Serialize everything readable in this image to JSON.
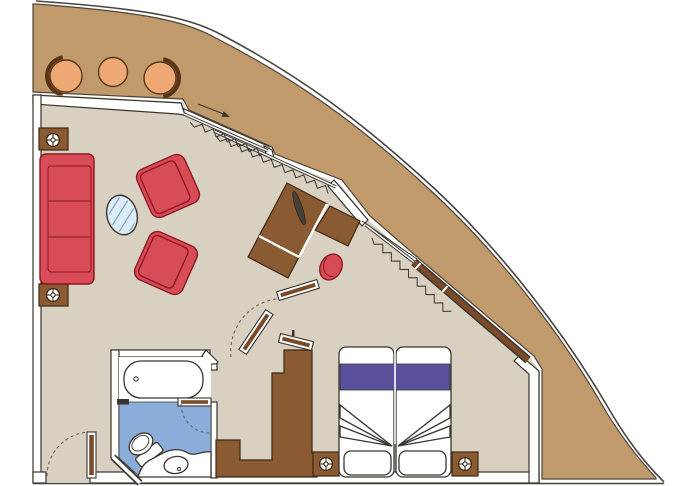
{
  "title": "cruise-suite-floor-plan",
  "colors": {
    "hull": "#c19a6b",
    "hull_line": "#4a443c",
    "floor": "#d8d0c0",
    "wall_line": "#39352d",
    "wall_fill": "#ffffff",
    "red": "#d84c57",
    "red_dark": "#8c1722",
    "brown": "#8a5a33",
    "brown_dark": "#3c2812",
    "door_brown": "#7b4a28",
    "peach": "#eda873",
    "peach_dark": "#5a3416",
    "blue": "#8badda",
    "purple": "#59519b",
    "glass": "#dcecf8",
    "glass_line": "#7aa2c4",
    "dash": "#6b6258",
    "tv": "#44403a"
  },
  "rooms": [
    {
      "name": "balcony",
      "furniture": [
        "curved-chair",
        "round-table",
        "curved-chair"
      ]
    },
    {
      "name": "living-room",
      "furniture": [
        "sofa",
        "side-table-lamp",
        "side-table-lamp",
        "armchair",
        "armchair",
        "oval-glass-coffee-table"
      ]
    },
    {
      "name": "work-area",
      "furniture": [
        "tv-cabinet",
        "desk",
        "stool",
        "tv"
      ]
    },
    {
      "name": "bathroom",
      "furniture": [
        "bathtub",
        "toilet",
        "sink"
      ]
    },
    {
      "name": "bedroom",
      "furniture": [
        "double-bed",
        "nightstand-lamp",
        "nightstand-lamp",
        "wardrobe"
      ]
    }
  ],
  "openings": [
    {
      "name": "entrance-door",
      "type": "swing"
    },
    {
      "name": "bathroom-door",
      "type": "swing"
    },
    {
      "name": "interior-doors",
      "type": "swing"
    },
    {
      "name": "balcony-sliding-door-living",
      "type": "sliding"
    },
    {
      "name": "balcony-sliding-door-bedroom",
      "type": "sliding"
    },
    {
      "name": "bedroom-window",
      "type": "fixed"
    }
  ]
}
